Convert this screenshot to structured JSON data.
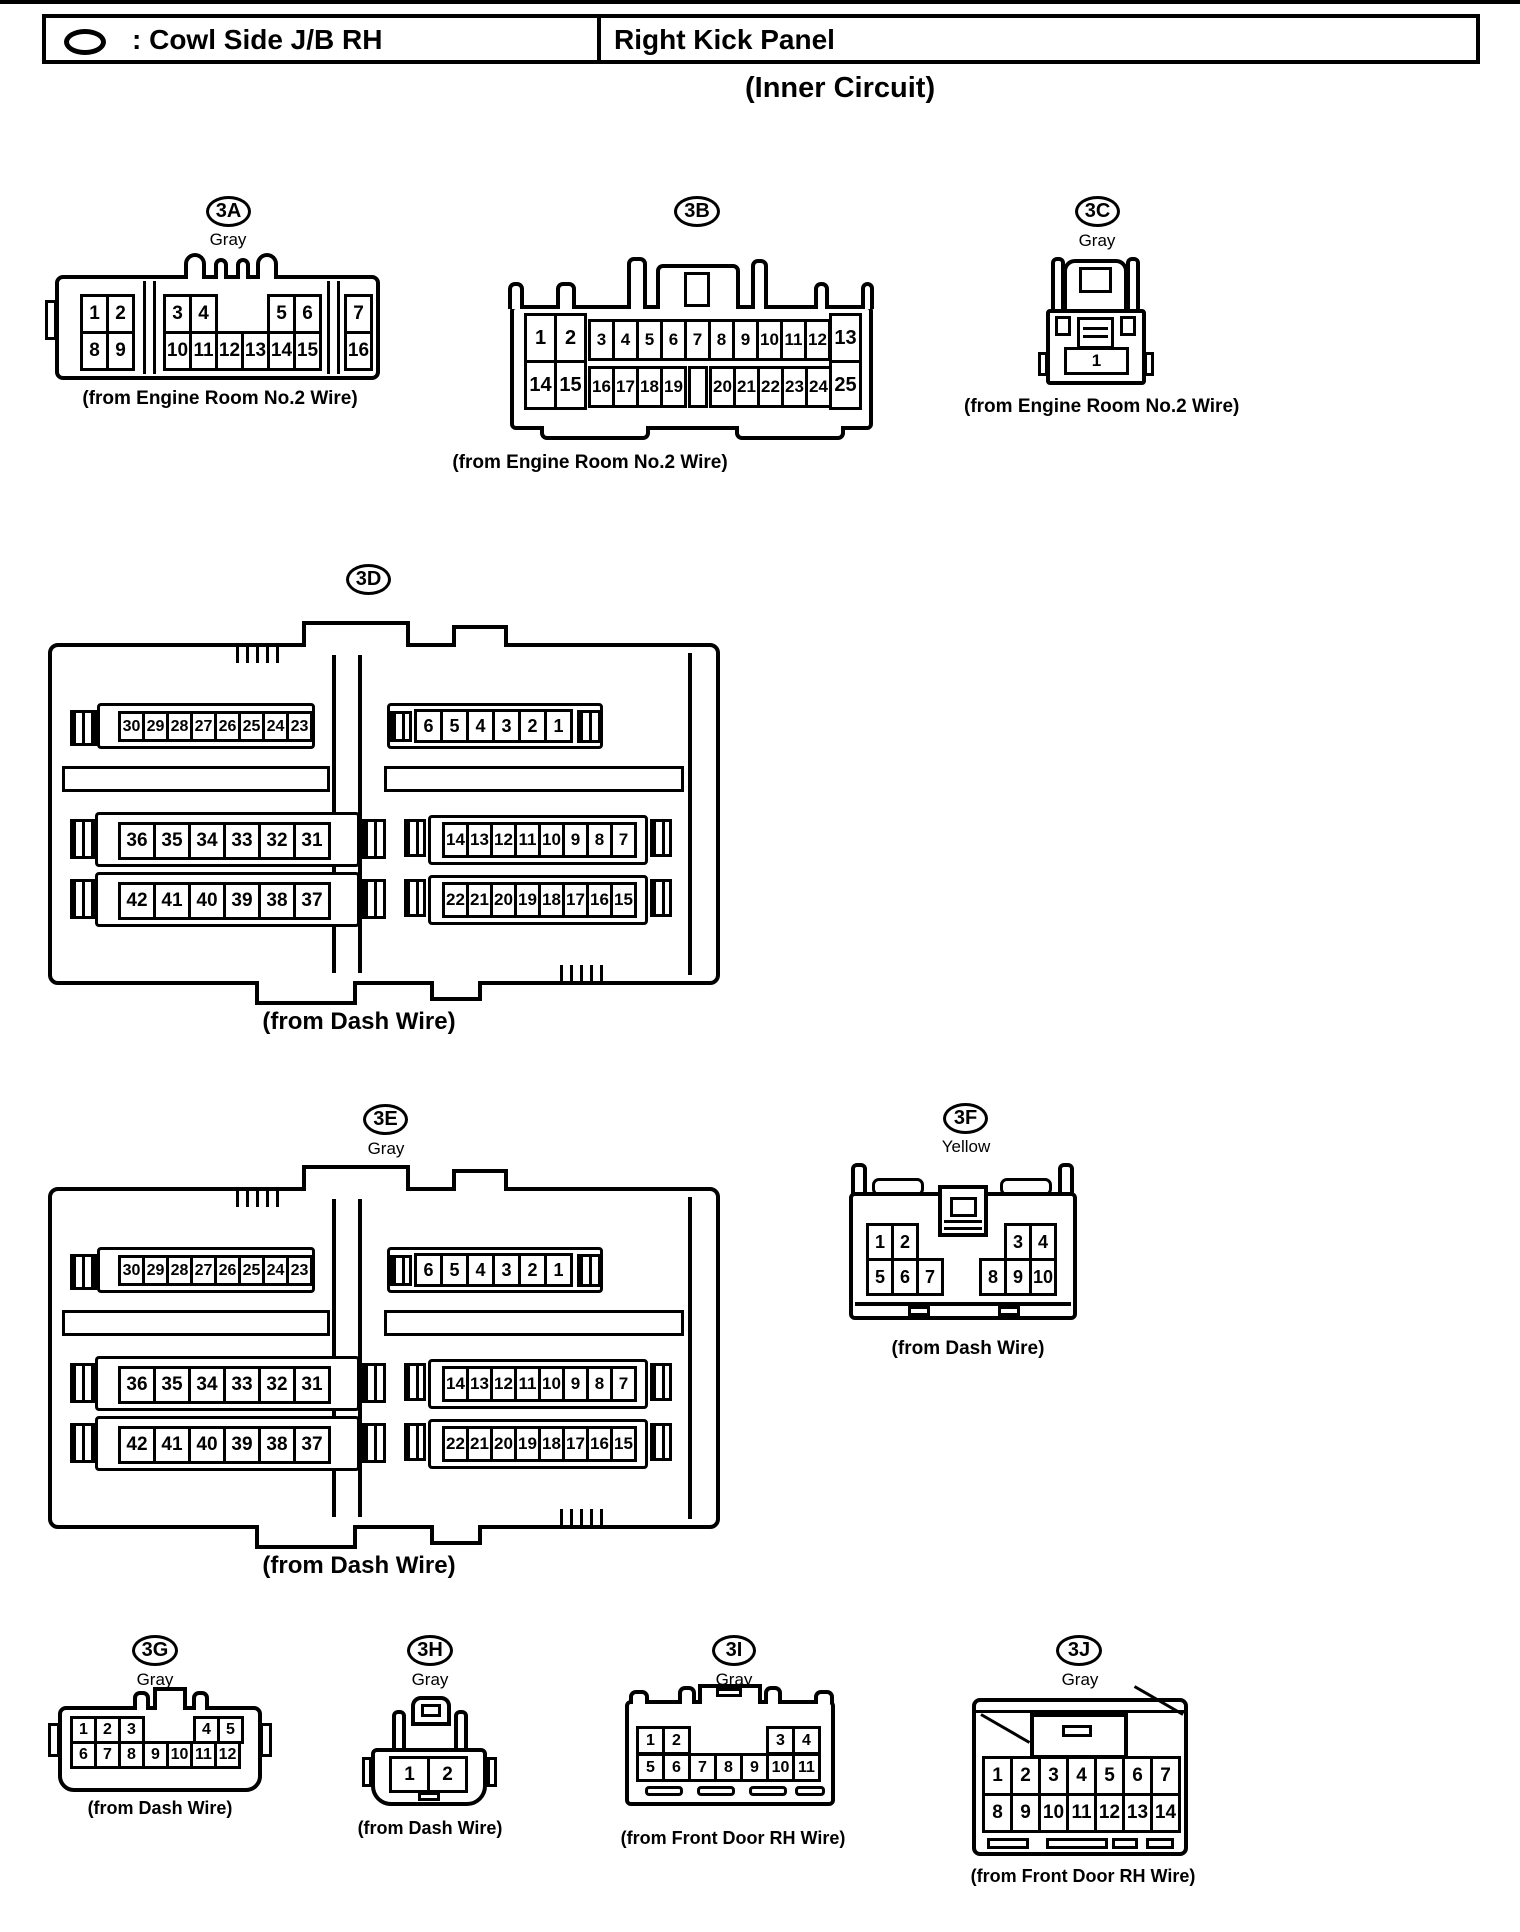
{
  "colors": {
    "ink": "#000000",
    "paper": "#ffffff"
  },
  "header": {
    "symbol": "oval-connector-symbol",
    "title_left": ": Cowl Side J/B RH",
    "title_right": "Right Kick Panel",
    "subtitle": "(Inner Circuit)"
  },
  "connectors": {
    "c3A": {
      "id": "3A",
      "color": "Gray",
      "caption": "(from Engine Room No.2 Wire)",
      "rows": [
        {
          "groups": [
            [
              "1",
              "2"
            ],
            [
              "3",
              "4"
            ],
            [
              "5",
              "6"
            ],
            [
              "7"
            ]
          ]
        },
        {
          "groups": [
            [
              "8",
              "9"
            ],
            [
              "10",
              "11",
              "12",
              "13",
              "14",
              "15"
            ],
            [
              "16"
            ]
          ]
        }
      ]
    },
    "c3B": {
      "id": "3B",
      "color": "",
      "caption": "(from Engine Room No.2 Wire)",
      "rows": [
        {
          "groups": [
            [
              "1",
              "2"
            ],
            [
              "3",
              "4",
              "5",
              "6",
              "7",
              "8",
              "9",
              "10",
              "11",
              "12"
            ],
            [
              "13"
            ]
          ]
        },
        {
          "groups": [
            [
              "14",
              "15"
            ],
            [
              "16",
              "17",
              "18",
              "19"
            ],
            [
              ""
            ],
            [
              "20",
              "21",
              "22",
              "23",
              "24"
            ],
            [
              "25"
            ]
          ]
        }
      ]
    },
    "c3C": {
      "id": "3C",
      "color": "Gray",
      "caption": "(from Engine Room No.2 Wire)",
      "rows": [
        {
          "groups": [
            [
              "1"
            ]
          ]
        }
      ]
    },
    "c3D": {
      "id": "3D",
      "color": "",
      "caption": "(from Dash Wire)",
      "rows": [
        {
          "groups": [
            [
              "30",
              "29",
              "28",
              "27",
              "26",
              "25",
              "24",
              "23"
            ],
            [
              "6",
              "5",
              "4",
              "3",
              "2",
              "1"
            ]
          ]
        },
        {
          "groups": [
            [
              "36",
              "35",
              "34",
              "33",
              "32",
              "31"
            ],
            [
              "14",
              "13",
              "12",
              "11",
              "10",
              "9",
              "8",
              "7"
            ]
          ]
        },
        {
          "groups": [
            [
              "42",
              "41",
              "40",
              "39",
              "38",
              "37"
            ],
            [
              "22",
              "21",
              "20",
              "19",
              "18",
              "17",
              "16",
              "15"
            ]
          ]
        }
      ]
    },
    "c3E": {
      "id": "3E",
      "color": "Gray",
      "caption": "(from Dash Wire)",
      "rows": [
        {
          "groups": [
            [
              "30",
              "29",
              "28",
              "27",
              "26",
              "25",
              "24",
              "23"
            ],
            [
              "6",
              "5",
              "4",
              "3",
              "2",
              "1"
            ]
          ]
        },
        {
          "groups": [
            [
              "36",
              "35",
              "34",
              "33",
              "32",
              "31"
            ],
            [
              "14",
              "13",
              "12",
              "11",
              "10",
              "9",
              "8",
              "7"
            ]
          ]
        },
        {
          "groups": [
            [
              "42",
              "41",
              "40",
              "39",
              "38",
              "37"
            ],
            [
              "22",
              "21",
              "20",
              "19",
              "18",
              "17",
              "16",
              "15"
            ]
          ]
        }
      ]
    },
    "c3F": {
      "id": "3F",
      "color": "Yellow",
      "caption": "(from Dash Wire)",
      "rows": [
        {
          "groups": [
            [
              "1",
              "2"
            ],
            [
              "3",
              "4"
            ]
          ]
        },
        {
          "groups": [
            [
              "5",
              "6",
              "7"
            ],
            [
              "8",
              "9",
              "10"
            ]
          ]
        }
      ]
    },
    "c3G": {
      "id": "3G",
      "color": "Gray",
      "caption": "(from Dash Wire)",
      "rows": [
        {
          "groups": [
            [
              "1",
              "2",
              "3"
            ],
            [
              "4",
              "5"
            ]
          ]
        },
        {
          "groups": [
            [
              "6",
              "7",
              "8",
              "9",
              "10",
              "11",
              "12"
            ]
          ]
        }
      ]
    },
    "c3H": {
      "id": "3H",
      "color": "Gray",
      "caption": "(from Dash Wire)",
      "rows": [
        {
          "groups": [
            [
              "1",
              "2"
            ]
          ]
        }
      ]
    },
    "c3I": {
      "id": "3I",
      "color": "Gray",
      "caption": "(from Front Door RH Wire)",
      "rows": [
        {
          "groups": [
            [
              "1",
              "2"
            ],
            [
              "3",
              "4"
            ]
          ]
        },
        {
          "groups": [
            [
              "5",
              "6",
              "7",
              "8",
              "9",
              "10",
              "11"
            ]
          ]
        }
      ]
    },
    "c3J": {
      "id": "3J",
      "color": "Gray",
      "caption": "(from Front Door RH Wire)",
      "rows": [
        {
          "groups": [
            [
              "1",
              "2",
              "3",
              "4",
              "5",
              "6",
              "7"
            ]
          ]
        },
        {
          "groups": [
            [
              "8",
              "9",
              "10",
              "11",
              "12",
              "13",
              "14"
            ]
          ]
        }
      ]
    }
  }
}
